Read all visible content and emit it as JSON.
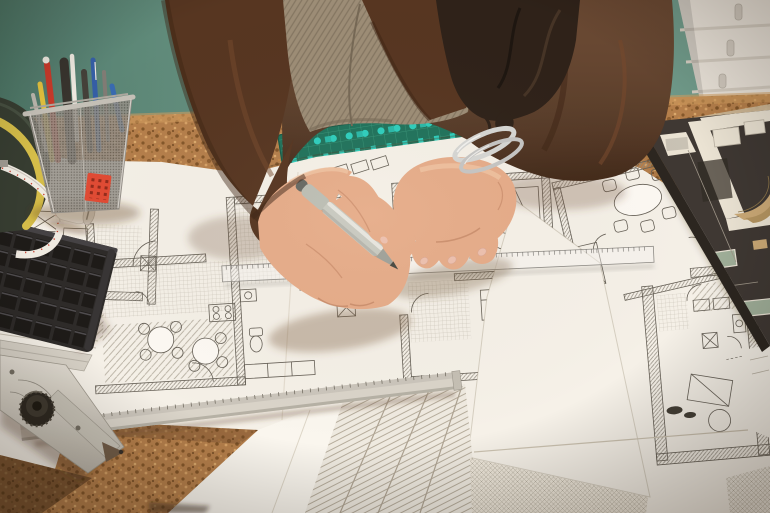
{
  "scene": {
    "description": "Architect drawing on floor plan blueprints with a grey marker guided by a clear ruler, at a cork-topped desk with drafting tools, keyboard, pen cup, cutting mat and an architectural site model board",
    "objects": [
      {
        "id": "wall",
        "label": "teal wall"
      },
      {
        "id": "drawer-unit",
        "label": "white drawer unit"
      },
      {
        "id": "desk",
        "label": "cork desk top"
      },
      {
        "id": "cutting-mat",
        "label": "green cutting mat"
      },
      {
        "id": "blueprint-sheets",
        "label": "white blueprint sheets"
      },
      {
        "id": "floor-plan-left",
        "label": "left floor plan fragment"
      },
      {
        "id": "floor-plan-main",
        "label": "main apartment floor plan"
      },
      {
        "id": "floor-plan-dining",
        "label": "dining room floor plan"
      },
      {
        "id": "floor-plan-corner",
        "label": "corner L-shaped floor plan"
      },
      {
        "id": "keyboard",
        "label": "black computer keyboard corner"
      },
      {
        "id": "metal-ruler",
        "label": "aluminium ruler"
      },
      {
        "id": "drafting-head",
        "label": "drafting machine head with knob"
      },
      {
        "id": "clear-ruler",
        "label": "transparent ruler under hands"
      },
      {
        "id": "model-board",
        "label": "black architectural site model board"
      },
      {
        "id": "pen-cup",
        "label": "wire mesh pen cup with pens"
      },
      {
        "id": "hard-hat",
        "label": "dark hard hat brim with yellow stripe"
      },
      {
        "id": "measuring-tape",
        "label": "white measuring tape"
      },
      {
        "id": "correction-roll",
        "label": "white correction tape roll"
      },
      {
        "id": "architect",
        "label": "architect in brown shirt and knit vest"
      },
      {
        "id": "marker-pen",
        "label": "grey marker pen"
      }
    ]
  },
  "colors": {
    "wall": "#558a7c",
    "cork": "#b27c49",
    "cork_dark": "#7e5226",
    "cork_mid": "#8a5a2e",
    "cork_light": "#d9a86c",
    "cork_light2": "#cf9c5e",
    "paper": "#f5f3ee",
    "paper_bright": "#faf9f5",
    "paper_shade": "#e3ded4",
    "line": "#5e5b55",
    "mat": "#156e5a",
    "mat_grid": "#2b8f75",
    "mat_dot": "#23cfc0",
    "board": "#353130",
    "board_side": "#211e1c",
    "model_white": "#eae5d9",
    "model_tan": "#c9a877",
    "model_tan2": "#b0925f",
    "model_green": "#9bae9b",
    "drawer": "#e9e5df",
    "drawer_side": "#d2cdc5",
    "keyboard": "#232325",
    "key": "#121214",
    "key_edge": "#46464c",
    "mesh": "#908e8a",
    "mesh_dot": "#54524e",
    "mesh_rim": "#c2c0bb",
    "pen_red": "#c63326",
    "pen_yellow": "#e3c23c",
    "pen_blue": "#2b59a8",
    "pen_blue2": "#2f66b4",
    "pen_black": "#2e2d2b",
    "pen_white": "#eceae5",
    "block_red": "#e04531",
    "block_red_dark": "#8e2418",
    "hat": "#2d362e",
    "hat_stripe": "#d3bd47",
    "tape": "#efece7",
    "metal": "#d8d5ce",
    "metal_dark": "#aaa79f",
    "knob": "#23211d",
    "ruler_clear": "rgba(248,248,250,0.42)",
    "marker": "#c6cac4",
    "marker_band": "#9aa09b",
    "marker_cap": "#5f6562",
    "marker_tip": "#3e423f",
    "skin": "#e5ab8b",
    "skin_shadow": "#bf8263",
    "nail": "#ecc0b2",
    "shirt": "#4f2f1d",
    "shirt_dark": "#331c0f",
    "vest": "#988b77",
    "vest_dark": "#6f6454",
    "hair": "#241a15",
    "bangle": "#d4d7d9",
    "button": "#6e4f3a"
  }
}
